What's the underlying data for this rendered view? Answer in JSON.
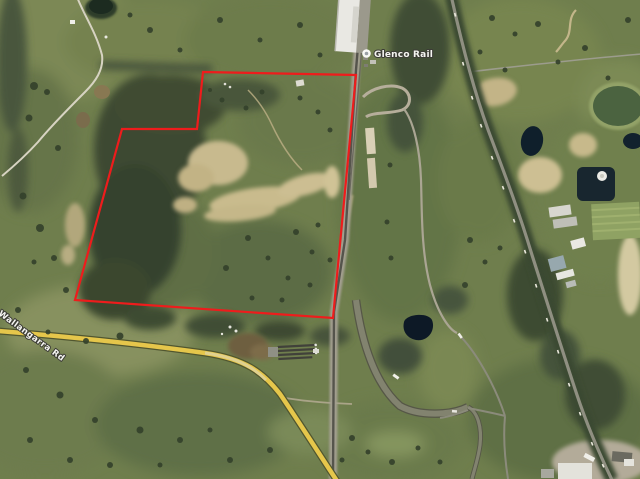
{
  "window": {
    "width": 640,
    "height": 479,
    "view_type": "satellite-aerial"
  },
  "map": {
    "labels": {
      "poi": {
        "text": "Glenco Rail",
        "icon": "map-poi-dot-icon"
      },
      "road": {
        "text": "Wallangarra Rd",
        "rotation_deg": 36
      }
    },
    "boundary_overlay": {
      "name": "property-boundary",
      "color": "#ee1c1c",
      "stroke_width": 2.2,
      "points": "203,72 356,75 333,318 75,300 122,129 197,129"
    },
    "colors": {
      "pasture_green": "#6f7e4d",
      "dark_forest": "#3a472f",
      "sand_quarry": "#c8ba8e",
      "local_road_yellow": "#e5c64b",
      "sealed_road_grey": "#82836f",
      "rail_corridor_grey": "#a39f90",
      "dam_water_dark": "#10202c",
      "building_white": "#e9e8e3",
      "boundary_red": "#ee1c1c"
    },
    "features": [
      {
        "name": "rail-corridor",
        "desc": "north-south railway with warehouse and sidings at top"
      },
      {
        "name": "highway",
        "desc": "tree-lined road running from upper right to lower right with vehicles"
      },
      {
        "name": "yellow-local-road",
        "desc": "yellow rural road across lower left curving to bottom edge"
      },
      {
        "name": "quarry-clearing",
        "desc": "sandy cleared patches inside red boundary"
      },
      {
        "name": "farm-dams",
        "desc": "dark farm dams east of the railway"
      },
      {
        "name": "property-boundary",
        "desc": "red parcel outline over bushland paddock"
      }
    ]
  }
}
